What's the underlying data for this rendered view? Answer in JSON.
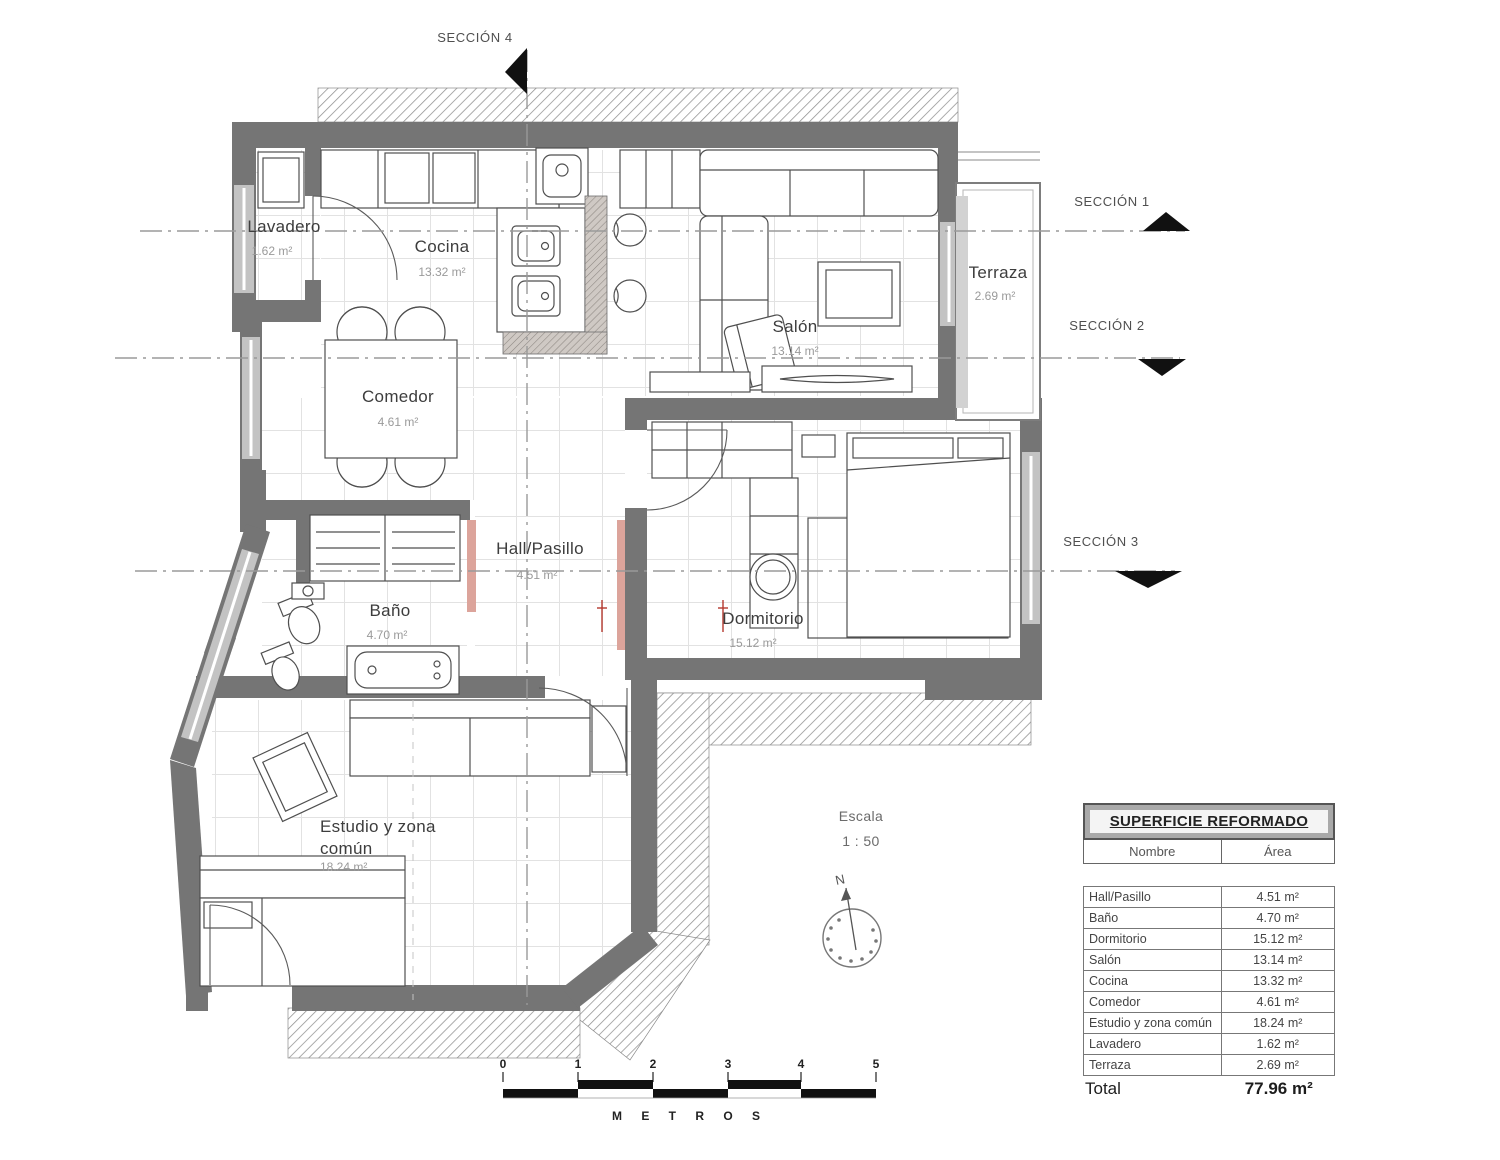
{
  "plan": {
    "rooms": {
      "lavadero": {
        "name": "Lavadero",
        "area": "1.62 m²"
      },
      "cocina": {
        "name": "Cocina",
        "area": "13.32 m²"
      },
      "salon": {
        "name": "Salón",
        "area": "13.14 m²"
      },
      "terraza": {
        "name": "Terraza",
        "area": "2.69 m²"
      },
      "comedor": {
        "name": "Comedor",
        "area": "4.61 m²"
      },
      "hall": {
        "name": "Hall/Pasillo",
        "area": "4.51 m²"
      },
      "bano": {
        "name": "Baño",
        "area": "4.70 m²"
      },
      "dormitorio": {
        "name": "Dormitorio",
        "area": "15.12 m²"
      },
      "estudio": {
        "name_line1": "Estudio y zona",
        "name_line2": "común",
        "area": "18.24 m²"
      }
    },
    "sections": {
      "s1": "SECCIÓN 1",
      "s2": "SECCIÓN 2",
      "s3": "SECCIÓN 3",
      "s4": "SECCIÓN 4"
    },
    "scale_note": {
      "label": "Escala",
      "value": "1 : 50"
    },
    "compass": {
      "north": "N"
    },
    "scale_bar": {
      "ticks": [
        "0",
        "1",
        "2",
        "3",
        "4",
        "5"
      ],
      "unit_label": "M E T R O S"
    }
  },
  "area_table": {
    "title": "SUPERFICIE REFORMADO",
    "col_name": "Nombre",
    "col_area": "Área",
    "rows": [
      {
        "name": "Hall/Pasillo",
        "area": "4.51 m²"
      },
      {
        "name": "Baño",
        "area": "4.70 m²"
      },
      {
        "name": "Dormitorio",
        "area": "15.12 m²"
      },
      {
        "name": "Salón",
        "area": "13.14 m²"
      },
      {
        "name": "Cocina",
        "area": "13.32 m²"
      },
      {
        "name": "Comedor",
        "area": "4.61 m²"
      },
      {
        "name": "Estudio y zona común",
        "area": "18.24 m²"
      },
      {
        "name": "Lavadero",
        "area": "1.62 m²"
      },
      {
        "name": "Terraza",
        "area": "2.69 m²"
      }
    ],
    "total_label": "Total",
    "total_value": "77.96 m²"
  },
  "colors": {
    "wall": "#757575",
    "window": "#c3c3c3",
    "hatch_line": "#909090",
    "new_partition_pink": "#dca49b",
    "marker_red": "#b5392f",
    "grid": "#e2e2e2"
  }
}
